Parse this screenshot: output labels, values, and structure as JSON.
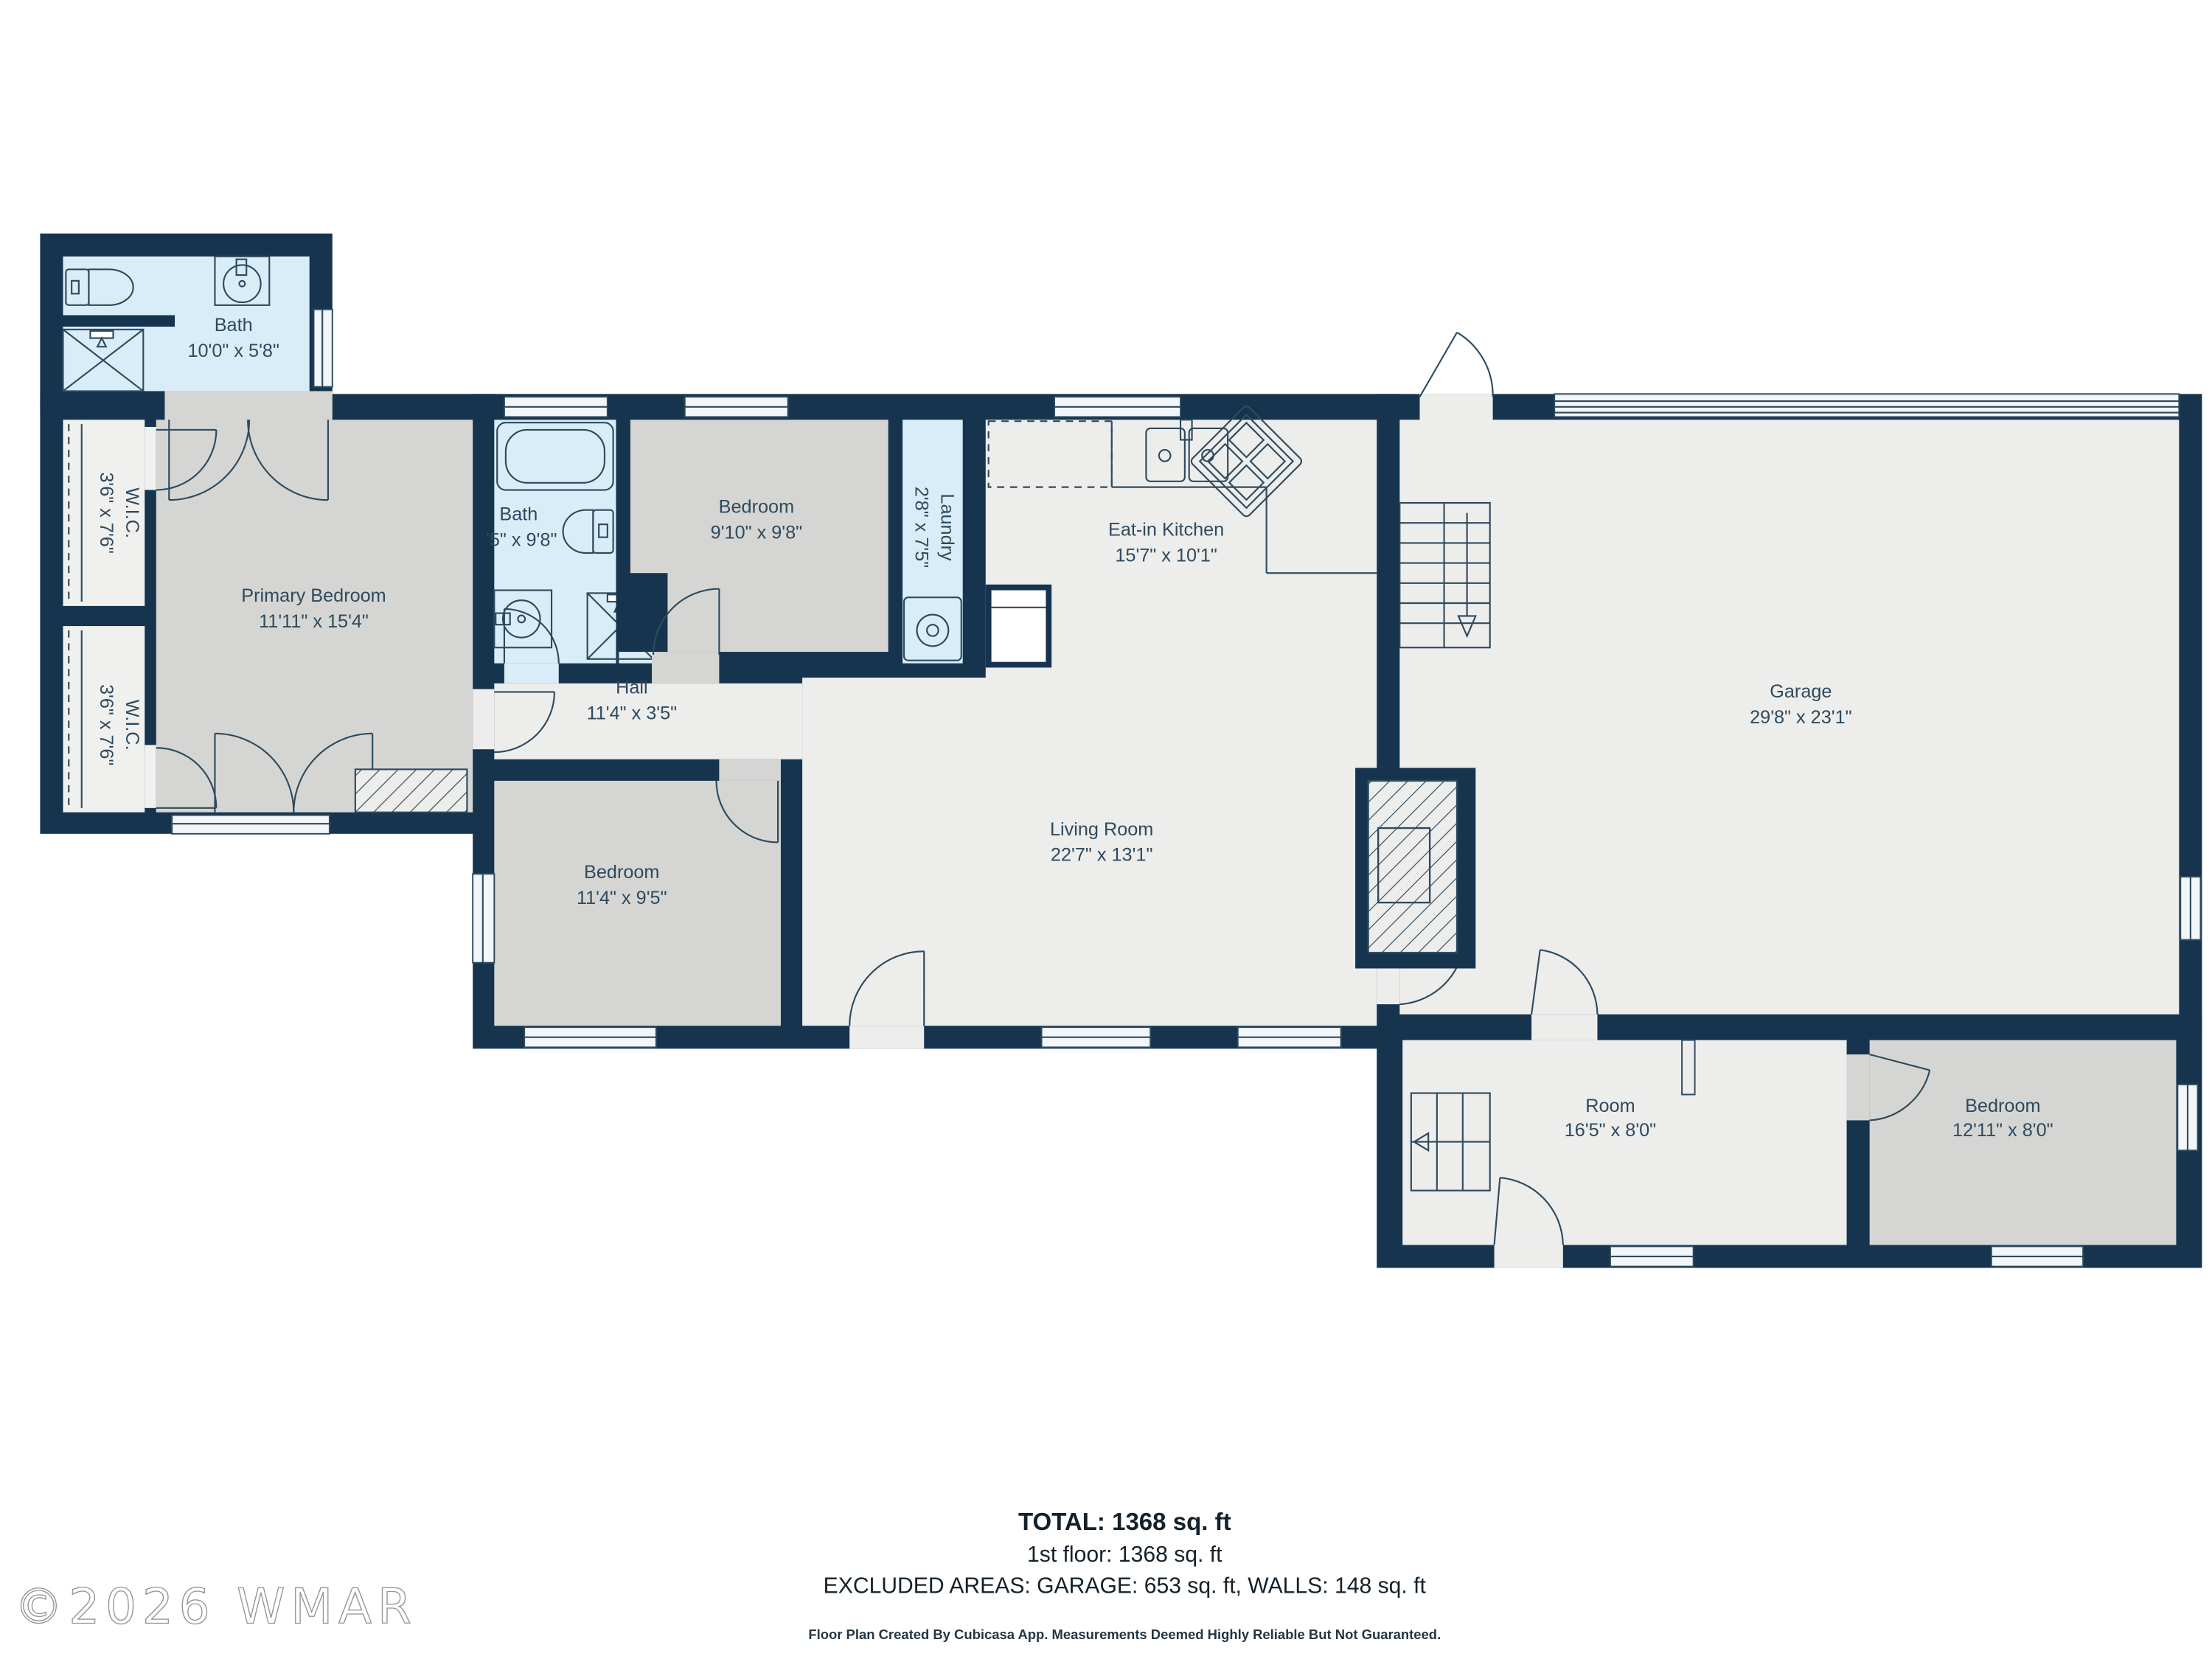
{
  "rooms": [
    {
      "id": "bath-1",
      "name": "Bath",
      "dims": "10'0\" x 5'8\""
    },
    {
      "id": "wic-1",
      "name": "W.I.C.",
      "dims": "3'6\" x 7'6\""
    },
    {
      "id": "wic-2",
      "name": "W.I.C.",
      "dims": "3'6\" x 7'6\""
    },
    {
      "id": "primary-bedroom",
      "name": "Primary Bedroom",
      "dims": "11'11\" x 15'4\""
    },
    {
      "id": "bath-2",
      "name": "Bath",
      "dims": "'5\" x 9'8\""
    },
    {
      "id": "bedroom-2",
      "name": "Bedroom",
      "dims": "9'10\" x 9'8\""
    },
    {
      "id": "laundry",
      "name": "Laundry",
      "dims": "2'8\" x 7'5\""
    },
    {
      "id": "eat-in-kitchen",
      "name": "Eat-in Kitchen",
      "dims": "15'7\" x 10'1\""
    },
    {
      "id": "hall",
      "name": "Hall",
      "dims": "11'4\" x 3'5\""
    },
    {
      "id": "living-room",
      "name": "Living Room",
      "dims": "22'7\" x 13'1\""
    },
    {
      "id": "bedroom-3",
      "name": "Bedroom",
      "dims": "11'4\" x 9'5\""
    },
    {
      "id": "garage",
      "name": "Garage",
      "dims": "29'8\" x 23'1\""
    },
    {
      "id": "room",
      "name": "Room",
      "dims": "16'5\" x 8'0\""
    },
    {
      "id": "bedroom-4",
      "name": "Bedroom",
      "dims": "12'11\" x 8'0\""
    }
  ],
  "summary": {
    "total": "TOTAL: 1368 sq. ft",
    "floor": "1st floor: 1368 sq. ft",
    "excluded": "EXCLUDED AREAS: GARAGE: 653 sq. ft, WALLS: 148 sq. ft",
    "disclaimer": "Floor Plan Created By Cubicasa App. Measurements Deemed Highly Reliable But Not Guaranteed."
  },
  "watermark": "©2026 WMAR",
  "colors": {
    "wall": "#16344e",
    "bath_fill": "#d9edf9",
    "bedroom_fill": "#d5d6d3",
    "floor_fill": "#ededec",
    "closet_fill": "#f0f0ee",
    "line": "#2e4a5e"
  }
}
